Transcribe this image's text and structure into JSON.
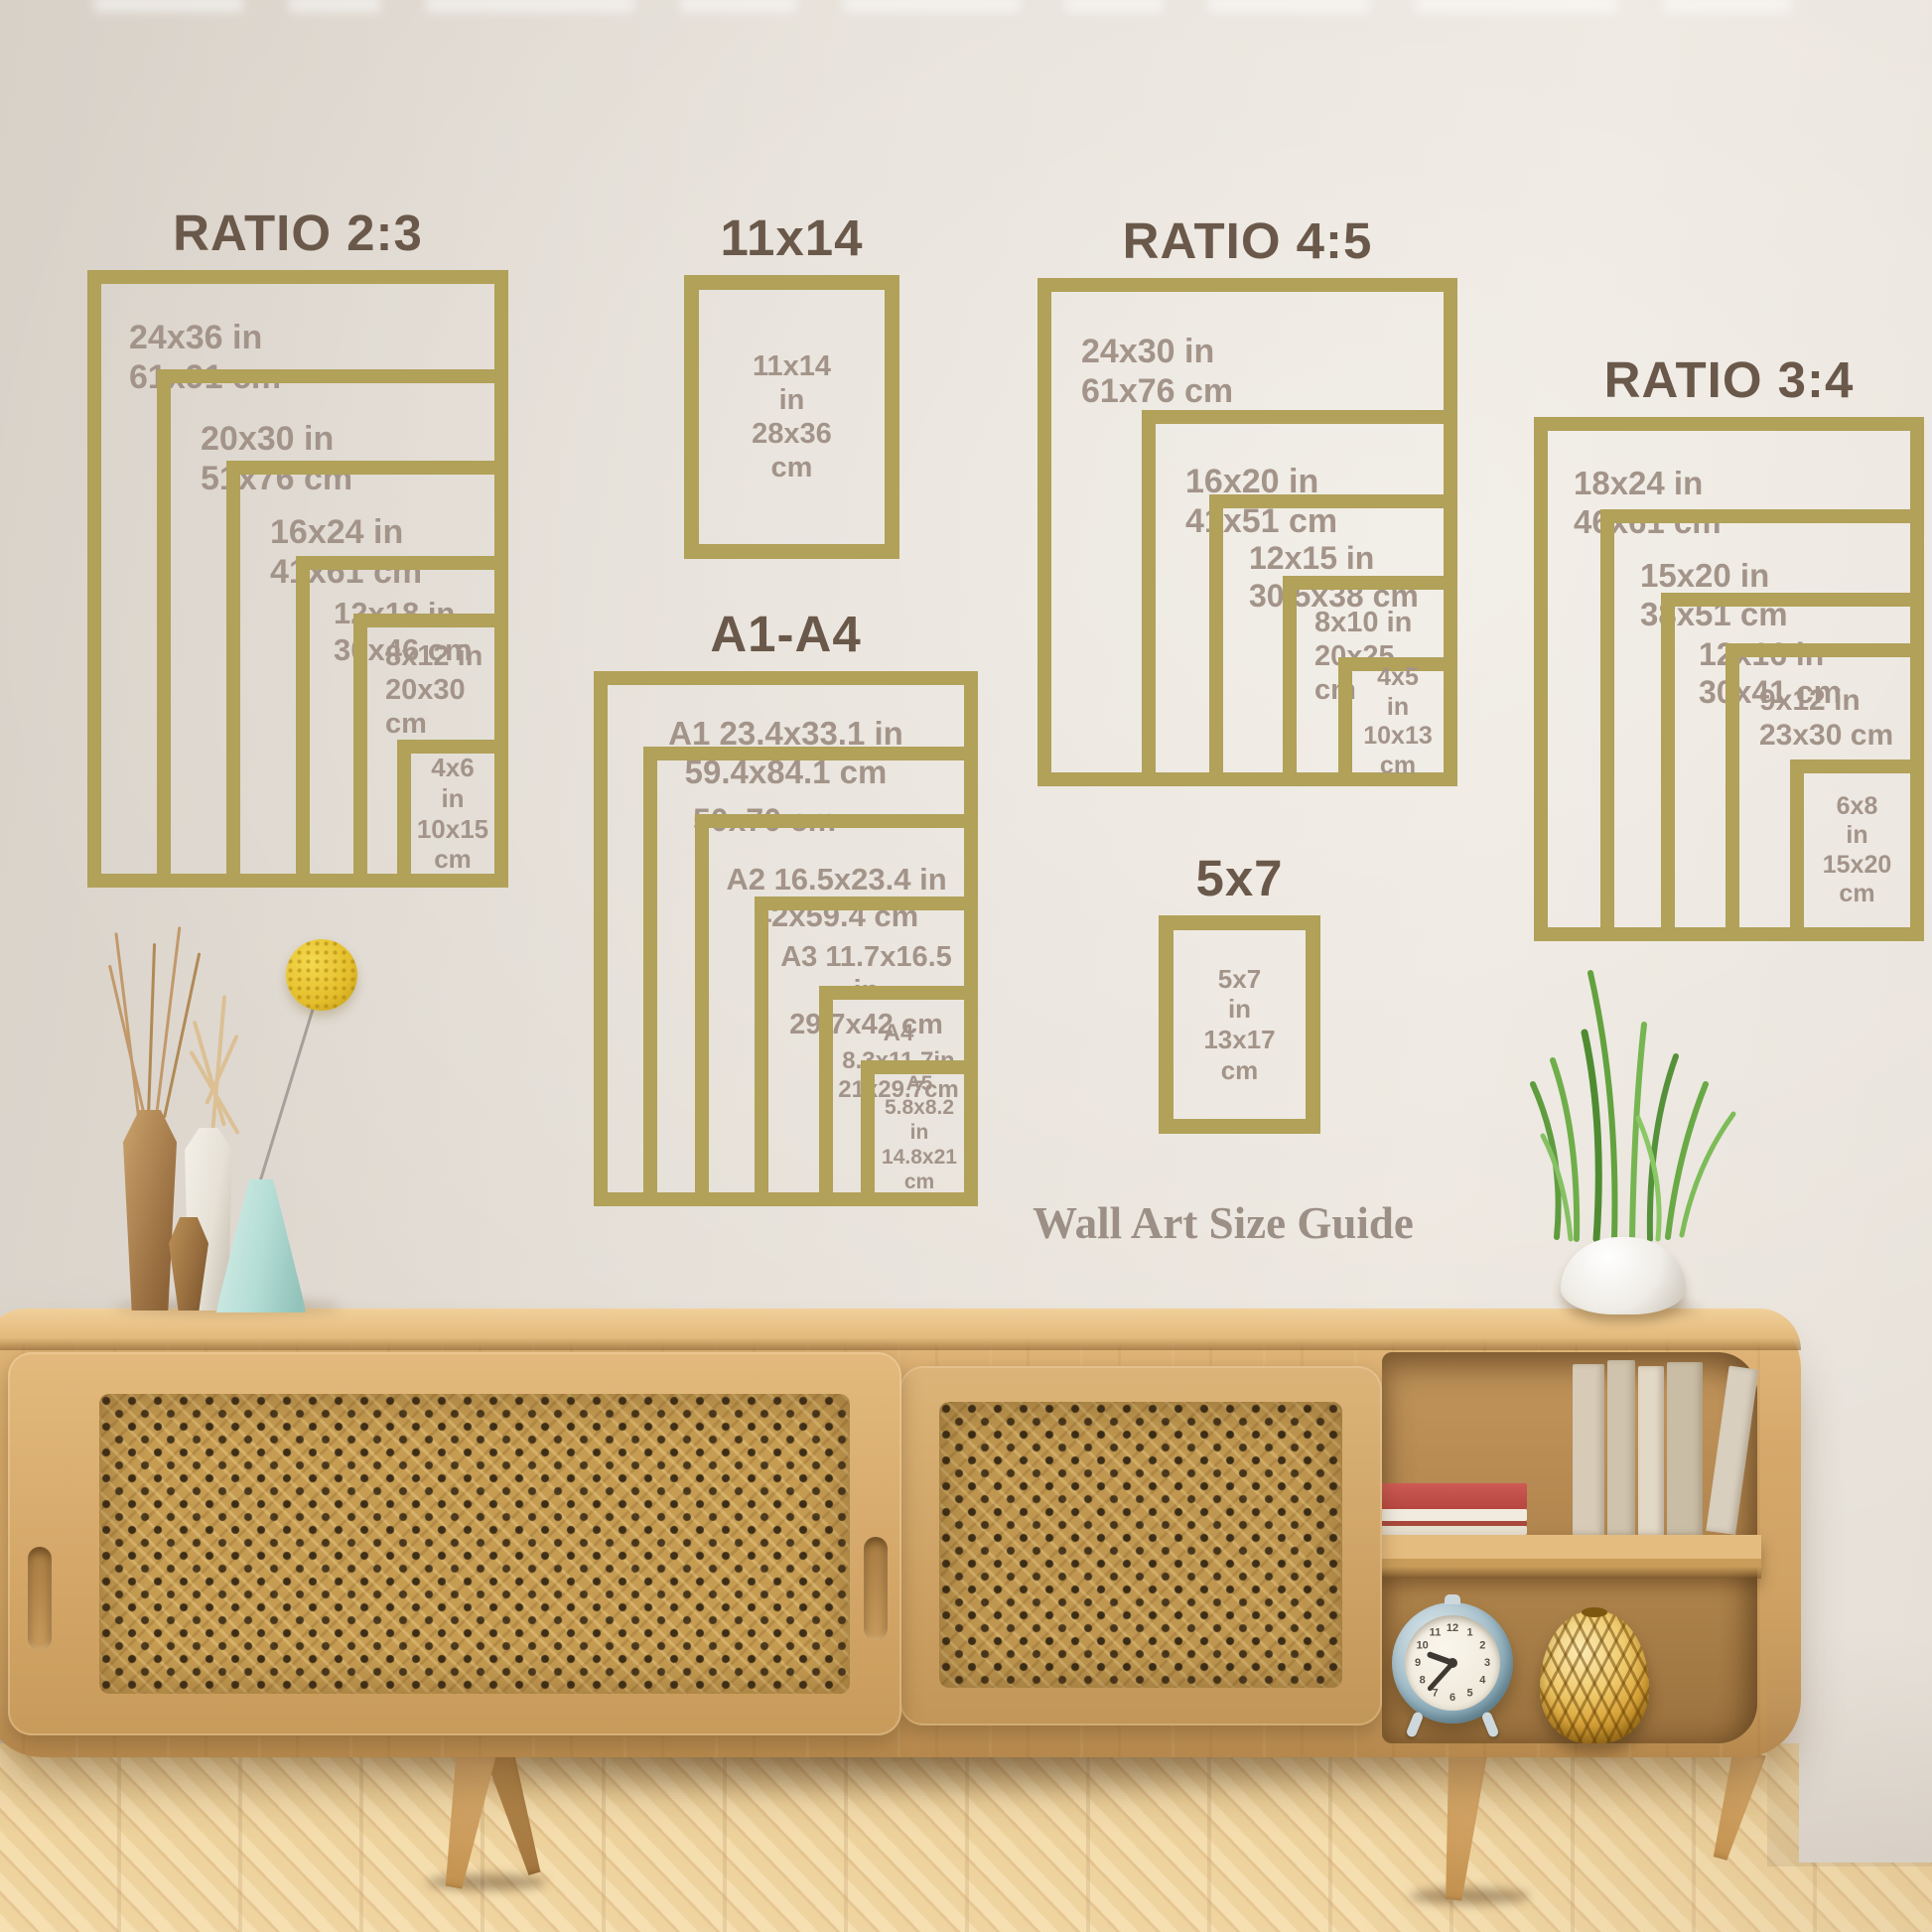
{
  "scene": {
    "caption": "Wall Art Size Guide"
  },
  "sets": [
    {
      "id": "ratio-2-3",
      "title": "RATIO 2:3",
      "frames": [
        {
          "label": "24x36 in\n61x91 cm"
        },
        {
          "label": "20x30 in\n51x76 cm"
        },
        {
          "label": "16x24 in\n41x61 cm"
        },
        {
          "label": "12x18 in\n30x46 cm"
        },
        {
          "label": "8x12 in\n20x30 cm"
        },
        {
          "label": "4x6\nin\n10x15\ncm"
        }
      ]
    },
    {
      "id": "size-11x14",
      "title": "11x14",
      "frames": [
        {
          "label": "11x14\nin\n28x36\ncm"
        }
      ]
    },
    {
      "id": "ratio-4-5",
      "title": "RATIO 4:5",
      "frames": [
        {
          "label": "24x30 in\n61x76 cm"
        },
        {
          "label": "16x20 in\n41x51 cm"
        },
        {
          "label": "12x15 in\n30.5x38 cm"
        },
        {
          "label": "8x10 in\n20x25 cm"
        },
        {
          "label": "4x5\nin\n10x13\ncm"
        }
      ]
    },
    {
      "id": "ratio-3-4",
      "title": "RATIO 3:4",
      "frames": [
        {
          "label": "18x24 in\n46x61 cm"
        },
        {
          "label": "15x20 in\n38x51 cm"
        },
        {
          "label": "12x16 in\n30x41 cm"
        },
        {
          "label": "9x12 in\n23x30 cm"
        },
        {
          "label": "6x8\nin\n15x20\ncm"
        }
      ]
    },
    {
      "id": "a1-a4",
      "title": "A1-A4",
      "frames": [
        {
          "label": "A1 23.4x33.1 in\n59.4x84.1 cm"
        },
        {
          "label": "50x70 cm"
        },
        {
          "label": "A2 16.5x23.4 in\n42x59.4 cm"
        },
        {
          "label": "A3 11.7x16.5 in\n29.7x42 cm"
        },
        {
          "label": "A4  8.3x11.7in\n21x29.7cm"
        },
        {
          "label": "A5\n5.8x8.2\nin\n14.8x21\ncm"
        }
      ]
    },
    {
      "id": "size-5x7",
      "title": "5x7",
      "frames": [
        {
          "label": "5x7\nin\n13x17\ncm"
        }
      ]
    }
  ],
  "clock": {
    "numerals": [
      "12",
      "1",
      "2",
      "3",
      "4",
      "5",
      "6",
      "7",
      "8",
      "9",
      "10",
      "11"
    ],
    "time_shown": "9:37"
  },
  "colors": {
    "frame_gold": "#b1a159",
    "title_brown": "#6a594a",
    "label_gray": "#a3948a",
    "caption_gray": "#9b8f86",
    "wood": "#d0a364",
    "floor": "#e2bb77",
    "mint_vase": "#b5ded6",
    "flower_yellow": "#e4be2b"
  }
}
